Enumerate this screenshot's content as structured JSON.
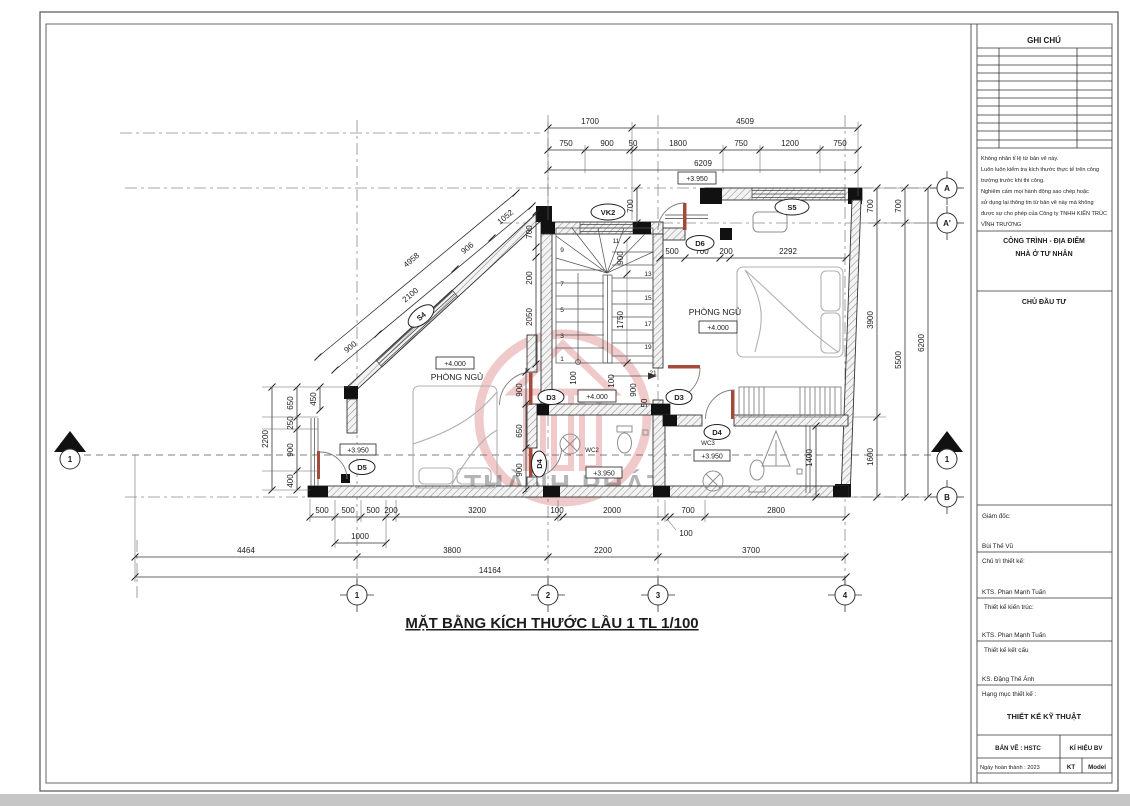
{
  "sheet": {
    "notes_title": "GHI CHÚ",
    "notes": [
      "Không nhân tỉ lệ từ bản vẽ này.",
      "Luôn luôn kiểm tra kích thước thực tế trên công",
      "trường trước khi thi công.",
      "Nghiêm cấm mọi hành động sao chép hoặc",
      "sử dụng lại thông tin từ bản vẽ này mà không",
      "được sự cho phép của Công ty TNHH KIẾN TRÚC",
      "VĨNH TRƯỜNG"
    ],
    "project_label": "CÔNG TRÌNH - ĐỊA ĐIỂM",
    "project_name": "NHÀ Ở TƯ NHÂN",
    "investor_label": "CHỦ ĐẦU TƯ",
    "director_label": "Giám đốc:",
    "director_name": "Bùi Thế Vũ",
    "lead_label": "Chủ trì thiết kế:",
    "lead_name": "KTS. Phan Mạnh Tuấn",
    "arch_label": "Thiết kế kiến trúc:",
    "arch_name": "KTS. Phan Mạnh Tuấn",
    "struct_label": "Thiết kế kết cấu",
    "struct_name": "KS. Đặng Thế Ánh",
    "category_label": "Hạng mục thiết kế :",
    "category_value": "THIẾT KẾ KỸ THUẬT",
    "drawing_label": "BẢN VẼ : HSTC",
    "symbol_label": "KÍ HIỆU BV",
    "date_label": "Ngày hoàn thành : 2023",
    "kt": "KT",
    "model": "Model"
  },
  "plan": {
    "title": "MẶT BẰNG KÍCH THƯỚC LẦU 1 TL 1/100",
    "watermark": "THÀNH PHÁT",
    "rooms": {
      "bedroom": "PHÒNG NGỦ",
      "wc2": "WC2",
      "wc3": "WC3"
    },
    "levels": {
      "p4000": "+4.000",
      "p3950": "+3.950"
    },
    "tags": {
      "S4": "S4",
      "S5": "S5",
      "VK2": "VK2",
      "D3": "D3",
      "D4": "D4",
      "D5": "D5",
      "D6": "D6"
    },
    "axis": {
      "a1": "1",
      "a2": "2",
      "a3": "3",
      "a4": "4",
      "A": "A",
      "A1": "A'",
      "B": "B"
    },
    "stairs": {
      "s1": "1",
      "s3": "3",
      "s5": "5",
      "s7": "7",
      "s9": "9",
      "s11": "11",
      "s13": "13",
      "s15": "15",
      "s17": "17",
      "s19": "19",
      "s21": "21"
    },
    "dm": {
      "50": "50",
      "100": "100",
      "200": "200",
      "250": "250",
      "400": "400",
      "450": "450",
      "500": "500",
      "650": "650",
      "700": "700",
      "750": "750",
      "900": "900",
      "906": "906",
      "1000": "1000",
      "1052": "1052",
      "1200": "1200",
      "1400": "1400",
      "1600": "1600",
      "1700": "1700",
      "1750": "1750",
      "1800": "1800",
      "2000": "2000",
      "2050": "2050",
      "2100": "2100",
      "2200": "2200",
      "2292": "2292",
      "2800": "2800",
      "3200": "3200",
      "3700": "3700",
      "3800": "3800",
      "3900": "3900",
      "4464": "4464",
      "4509": "4509",
      "4958": "4958",
      "5500": "5500",
      "6200": "6200",
      "6209": "6209",
      "14164": "14164"
    }
  },
  "colors": {
    "watermark": "#cc4444",
    "section_number": "#c87a2a",
    "paper": "#ffffff",
    "line": "#333333"
  }
}
